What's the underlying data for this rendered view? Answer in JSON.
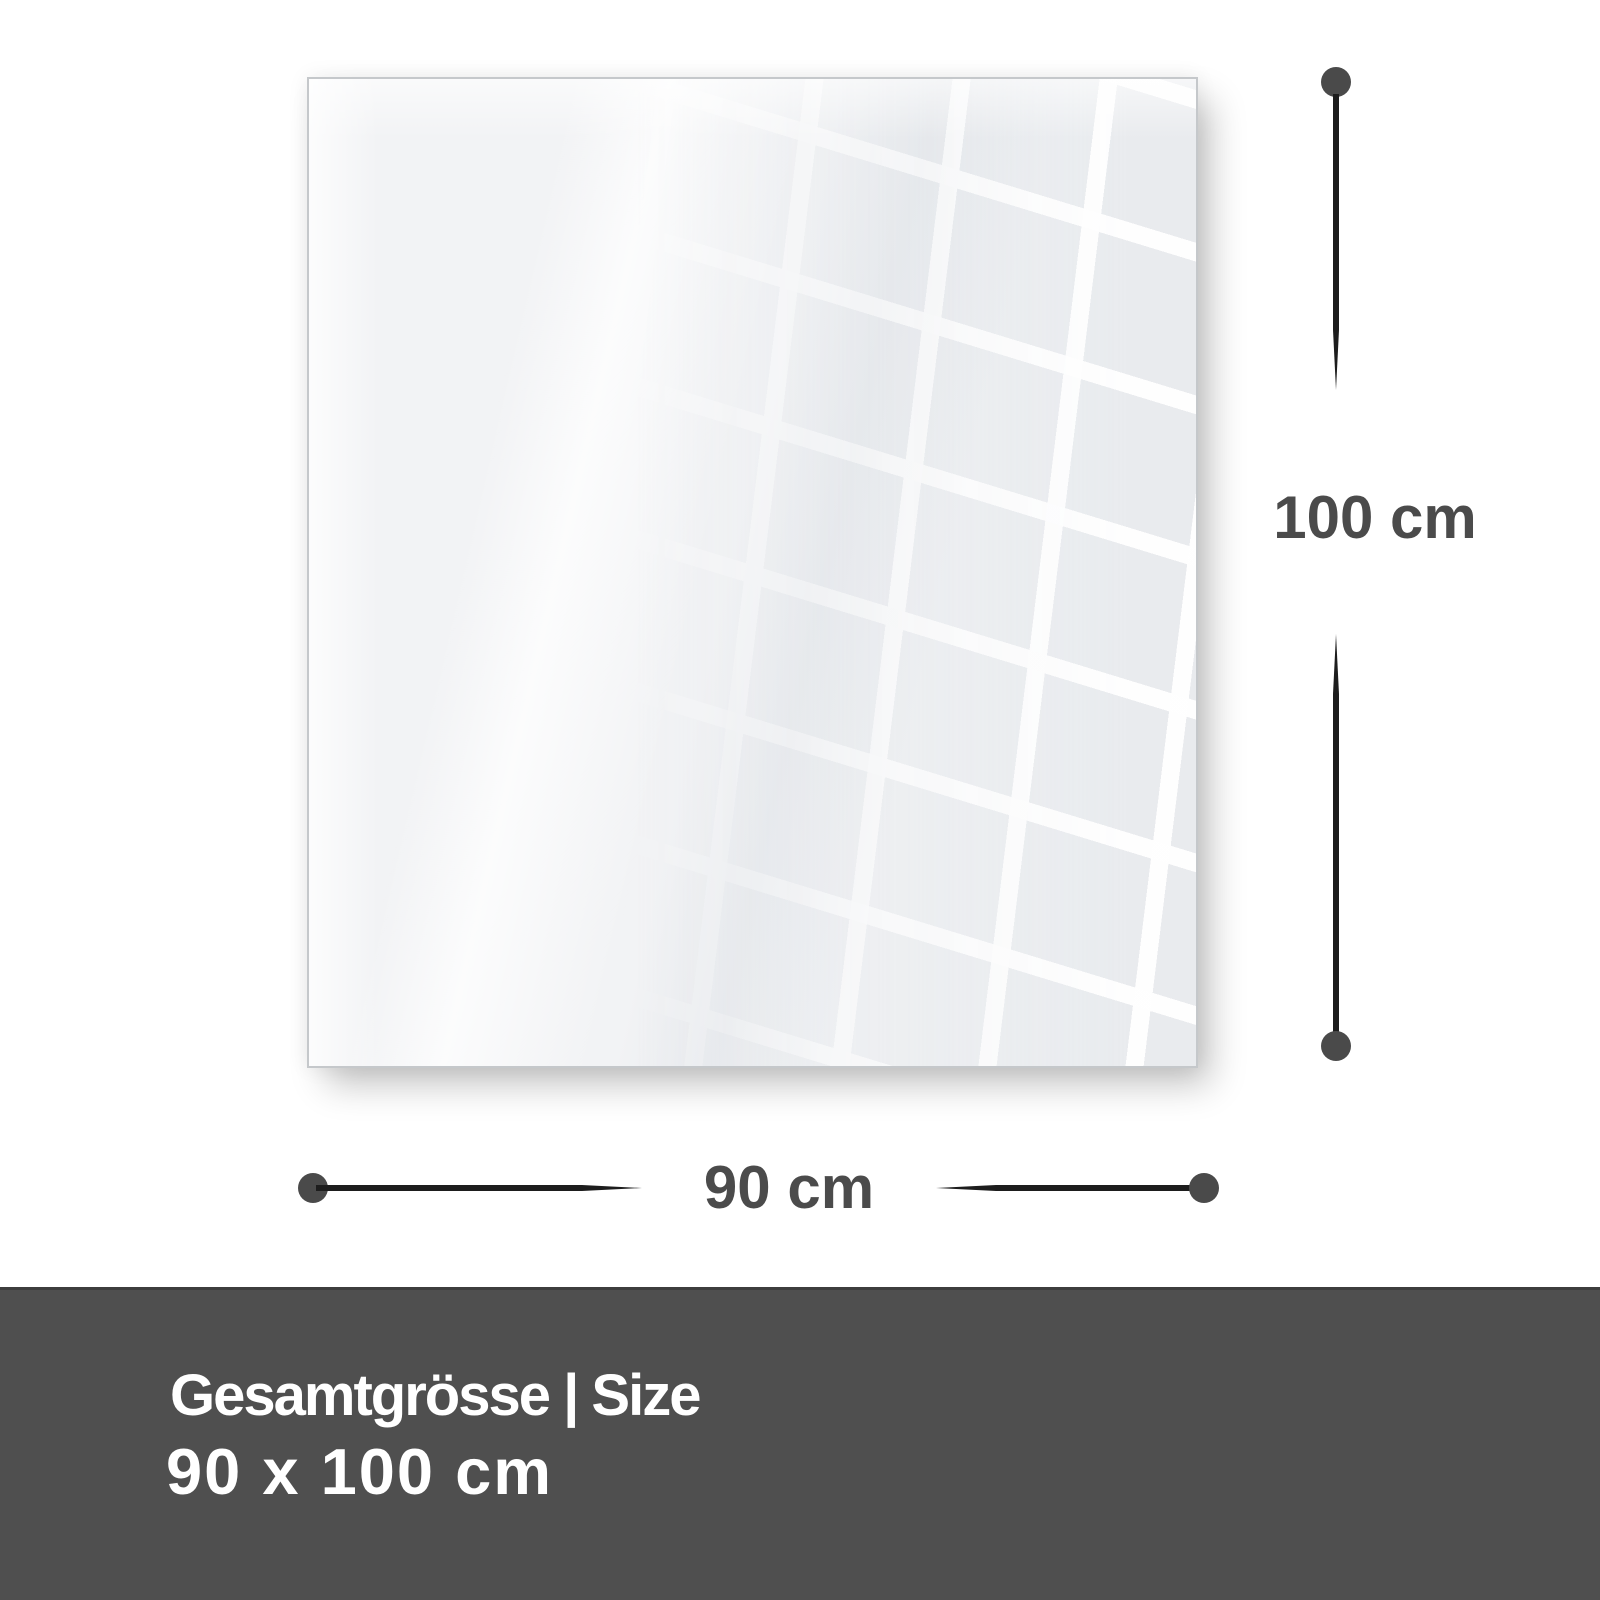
{
  "diagram": {
    "dimensions": {
      "height": {
        "label": "100 cm"
      },
      "width": {
        "label": "90 cm"
      }
    }
  },
  "footer": {
    "title": "Gesamtgrösse | Size",
    "size": "90 x 100 cm"
  },
  "colors": {
    "page_bg": "#ffffff",
    "panel_fill": "#f2f3f5",
    "panel_border": "#c5c8cb",
    "line": "#1d1d1d",
    "dot": "#4a4a4a",
    "dimension_text": "#4b4b4b",
    "footer_bg": "#4f4f4f",
    "footer_top_line": "#3d3d3d",
    "footer_text": "#ffffff"
  }
}
